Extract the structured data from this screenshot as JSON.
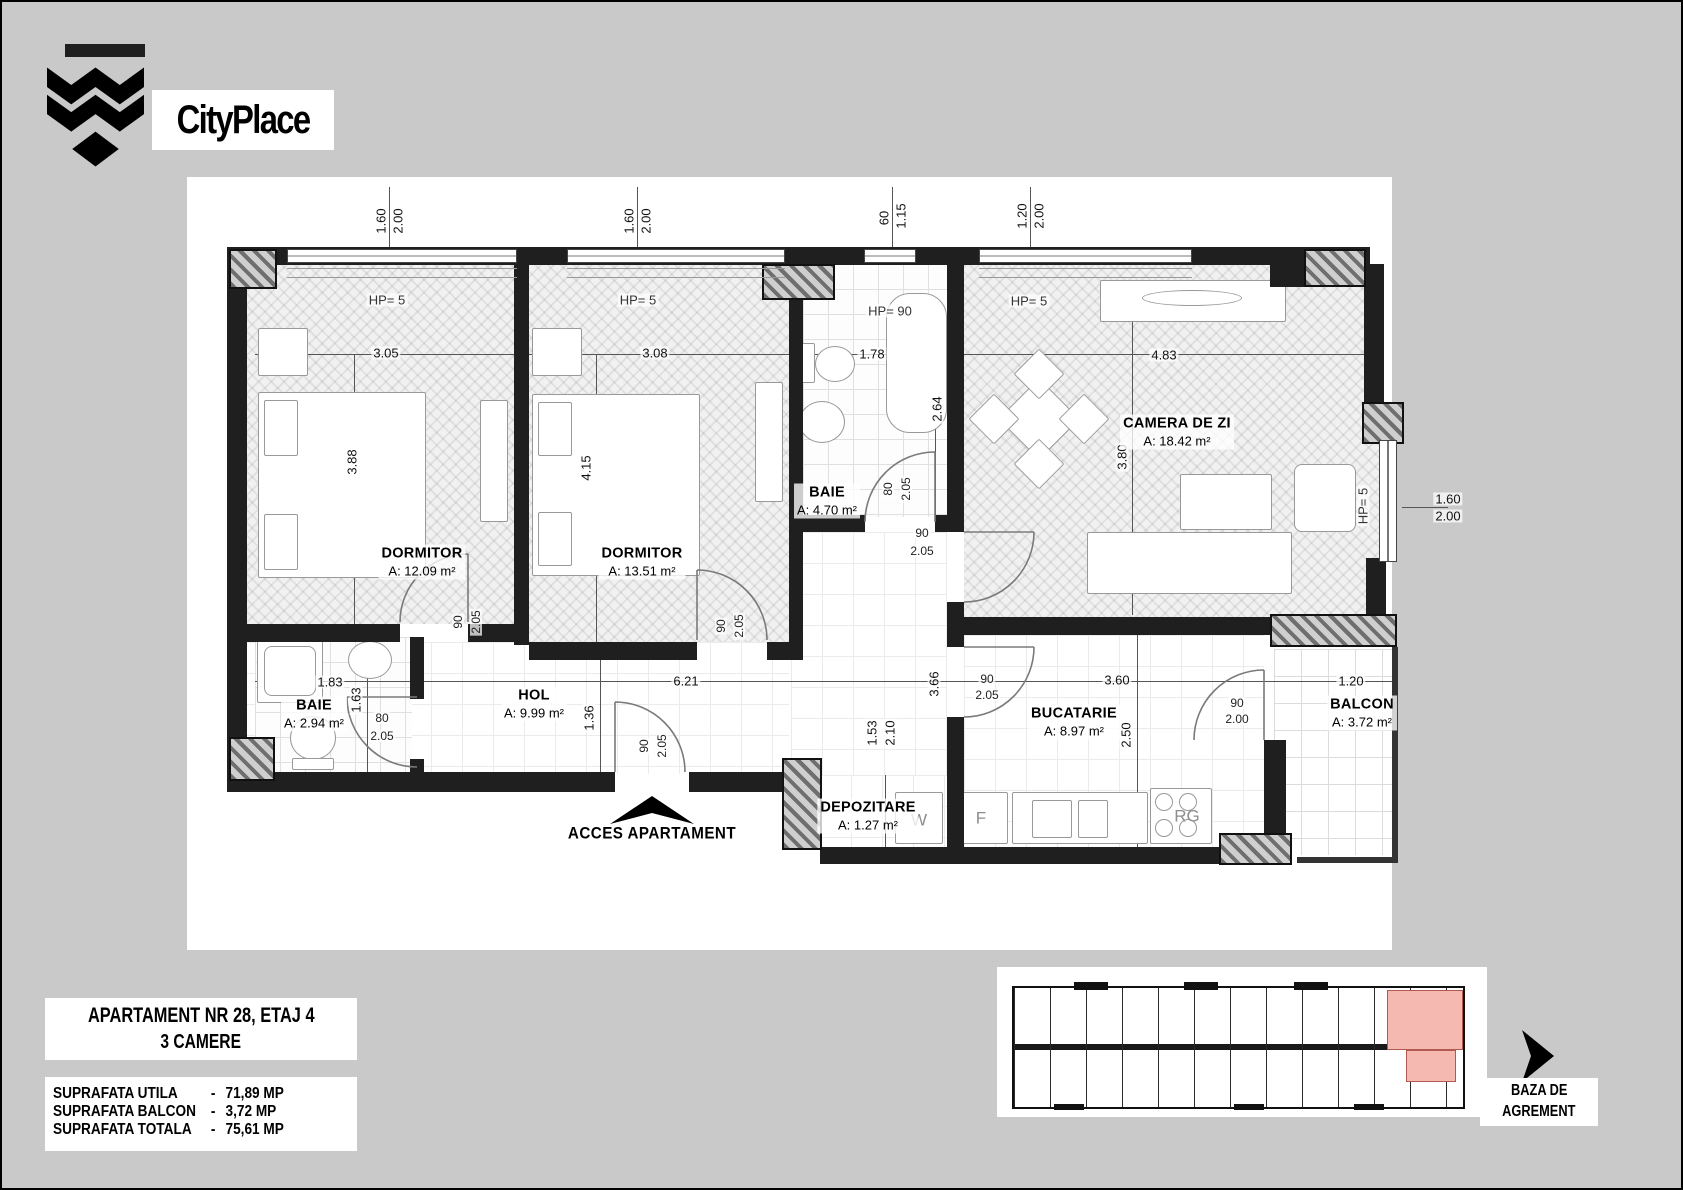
{
  "logo": {
    "brand": "CityPlace"
  },
  "title_block": {
    "line1": "APARTAMENT NR 28, ETAJ 4",
    "line2": "3 CAMERE"
  },
  "areas_table": {
    "rows": [
      {
        "label": "SUPRAFATA UTILA",
        "sep": "-",
        "value": "71,89 MP"
      },
      {
        "label": "SUPRAFATA BALCON",
        "sep": "-",
        "value": "3,72 MP"
      },
      {
        "label": "SUPRAFATA TOTALA",
        "sep": "-",
        "value": "75,61 MP"
      }
    ]
  },
  "key_plan": {
    "caption_line1": "BAZA DE",
    "caption_line2": "AGREMENT",
    "highlight_color": "#f5b9b1"
  },
  "colors": {
    "wall": "#1f1f1f",
    "background": "#c9c9c9",
    "sheet": "#ffffff",
    "highlight": "#f5b9b1"
  },
  "plan": {
    "access_label": "ACCES APARTAMENT",
    "rooms": [
      {
        "dn": "room-label-dormitor-1",
        "name": "DORMITOR",
        "area": "A: 12.09 m²",
        "x": 420,
        "y": 560
      },
      {
        "dn": "room-label-dormitor-2",
        "name": "DORMITOR",
        "area": "A: 13.51 m²",
        "x": 640,
        "y": 560
      },
      {
        "dn": "room-label-baie-1",
        "name": "BAIE",
        "area": "A: 4.70 m²",
        "x": 825,
        "y": 499
      },
      {
        "dn": "room-label-camera-de-zi",
        "name": "CAMERA DE ZI",
        "area": "A: 18.42 m²",
        "x": 1175,
        "y": 430
      },
      {
        "dn": "room-label-baie-2",
        "name": "BAIE",
        "area": "A: 2.94 m²",
        "x": 312,
        "y": 712
      },
      {
        "dn": "room-label-hol",
        "name": "HOL",
        "area": "A: 9.99 m²",
        "x": 532,
        "y": 702
      },
      {
        "dn": "room-label-depozitare",
        "name": "DEPOZITARE",
        "area": "A: 1.27 m²",
        "x": 866,
        "y": 814
      },
      {
        "dn": "room-label-bucatarie",
        "name": "BUCATARIE",
        "area": "A: 8.97 m²",
        "x": 1072,
        "y": 720
      },
      {
        "dn": "room-label-balcon",
        "name": "BALCON",
        "area": "A: 3.72 m²",
        "x": 1360,
        "y": 711
      }
    ],
    "dim_labels": [
      {
        "t": "3.05",
        "x": 384,
        "y": 351
      },
      {
        "t": "3.08",
        "x": 653,
        "y": 351
      },
      {
        "t": "1.78",
        "x": 870,
        "y": 352
      },
      {
        "t": "4.83",
        "x": 1162,
        "y": 353
      },
      {
        "t": "3.88",
        "x": 350,
        "y": 460,
        "r": 1
      },
      {
        "t": "4.15",
        "x": 584,
        "y": 466,
        "r": 1
      },
      {
        "t": "2.64",
        "x": 935,
        "y": 407,
        "r": 1
      },
      {
        "t": "3.80",
        "x": 1120,
        "y": 455,
        "r": 1
      },
      {
        "t": "1.83",
        "x": 328,
        "y": 680
      },
      {
        "t": "6.21",
        "x": 684,
        "y": 679
      },
      {
        "t": "3.66",
        "x": 932,
        "y": 682,
        "r": 1
      },
      {
        "t": "3.60",
        "x": 1115,
        "y": 678
      },
      {
        "t": "1.20",
        "x": 1349,
        "y": 679
      },
      {
        "t": "1.63",
        "x": 354,
        "y": 698,
        "r": 1
      },
      {
        "t": "1.36",
        "x": 587,
        "y": 716,
        "r": 1
      },
      {
        "t": "1.53",
        "x": 870,
        "y": 731,
        "r": 1
      },
      {
        "t": "2.10",
        "x": 888,
        "y": 731,
        "r": 1
      },
      {
        "t": "2.50",
        "x": 1124,
        "y": 733,
        "r": 1
      },
      {
        "t": "1.60",
        "x": 379,
        "y": 219,
        "r": 1
      },
      {
        "t": "2.00",
        "x": 396,
        "y": 219,
        "r": 1
      },
      {
        "t": "1.60",
        "x": 627,
        "y": 219,
        "r": 1
      },
      {
        "t": "2.00",
        "x": 644,
        "y": 219,
        "r": 1
      },
      {
        "t": "60",
        "x": 882,
        "y": 216,
        "r": 1
      },
      {
        "t": "1.15",
        "x": 899,
        "y": 214,
        "r": 1
      },
      {
        "t": "1.20",
        "x": 1020,
        "y": 214,
        "r": 1
      },
      {
        "t": "2.00",
        "x": 1037,
        "y": 214,
        "r": 1
      },
      {
        "t": "1.60",
        "x": 1446,
        "y": 497
      },
      {
        "t": "2.00",
        "x": 1446,
        "y": 514
      }
    ],
    "hp_labels": [
      {
        "t": "HP= 5",
        "x": 385,
        "y": 298
      },
      {
        "t": "HP= 5",
        "x": 636,
        "y": 298
      },
      {
        "t": "HP= 90",
        "x": 888,
        "y": 309
      },
      {
        "t": "HP= 5",
        "x": 1027,
        "y": 299
      },
      {
        "t": "HP= 5",
        "x": 1361,
        "y": 504,
        "r": 1
      }
    ],
    "door_labels": [
      {
        "t": "90",
        "x": 456,
        "y": 620,
        "r": 1
      },
      {
        "t": "2.05",
        "x": 474,
        "y": 620,
        "r": 1
      },
      {
        "t": "90",
        "x": 719,
        "y": 624,
        "r": 1
      },
      {
        "t": "2.05",
        "x": 737,
        "y": 624,
        "r": 1
      },
      {
        "t": "80",
        "x": 886,
        "y": 487,
        "r": 1
      },
      {
        "t": "2.05",
        "x": 904,
        "y": 487,
        "r": 1
      },
      {
        "t": "80",
        "x": 380,
        "y": 716
      },
      {
        "t": "2.05",
        "x": 380,
        "y": 734
      },
      {
        "t": "90",
        "x": 642,
        "y": 744,
        "r": 1
      },
      {
        "t": "2.05",
        "x": 660,
        "y": 744,
        "r": 1
      },
      {
        "t": "90",
        "x": 920,
        "y": 531
      },
      {
        "t": "2.05",
        "x": 920,
        "y": 549
      },
      {
        "t": "90",
        "x": 985,
        "y": 677
      },
      {
        "t": "2.05",
        "x": 985,
        "y": 693
      },
      {
        "t": "90",
        "x": 1235,
        "y": 701
      },
      {
        "t": "2.00",
        "x": 1235,
        "y": 717
      }
    ],
    "appliance_labels": [
      {
        "t": "W",
        "x": 917,
        "y": 818
      },
      {
        "t": "F",
        "x": 979,
        "y": 816
      },
      {
        "t": "RG",
        "x": 1185,
        "y": 814
      }
    ]
  }
}
